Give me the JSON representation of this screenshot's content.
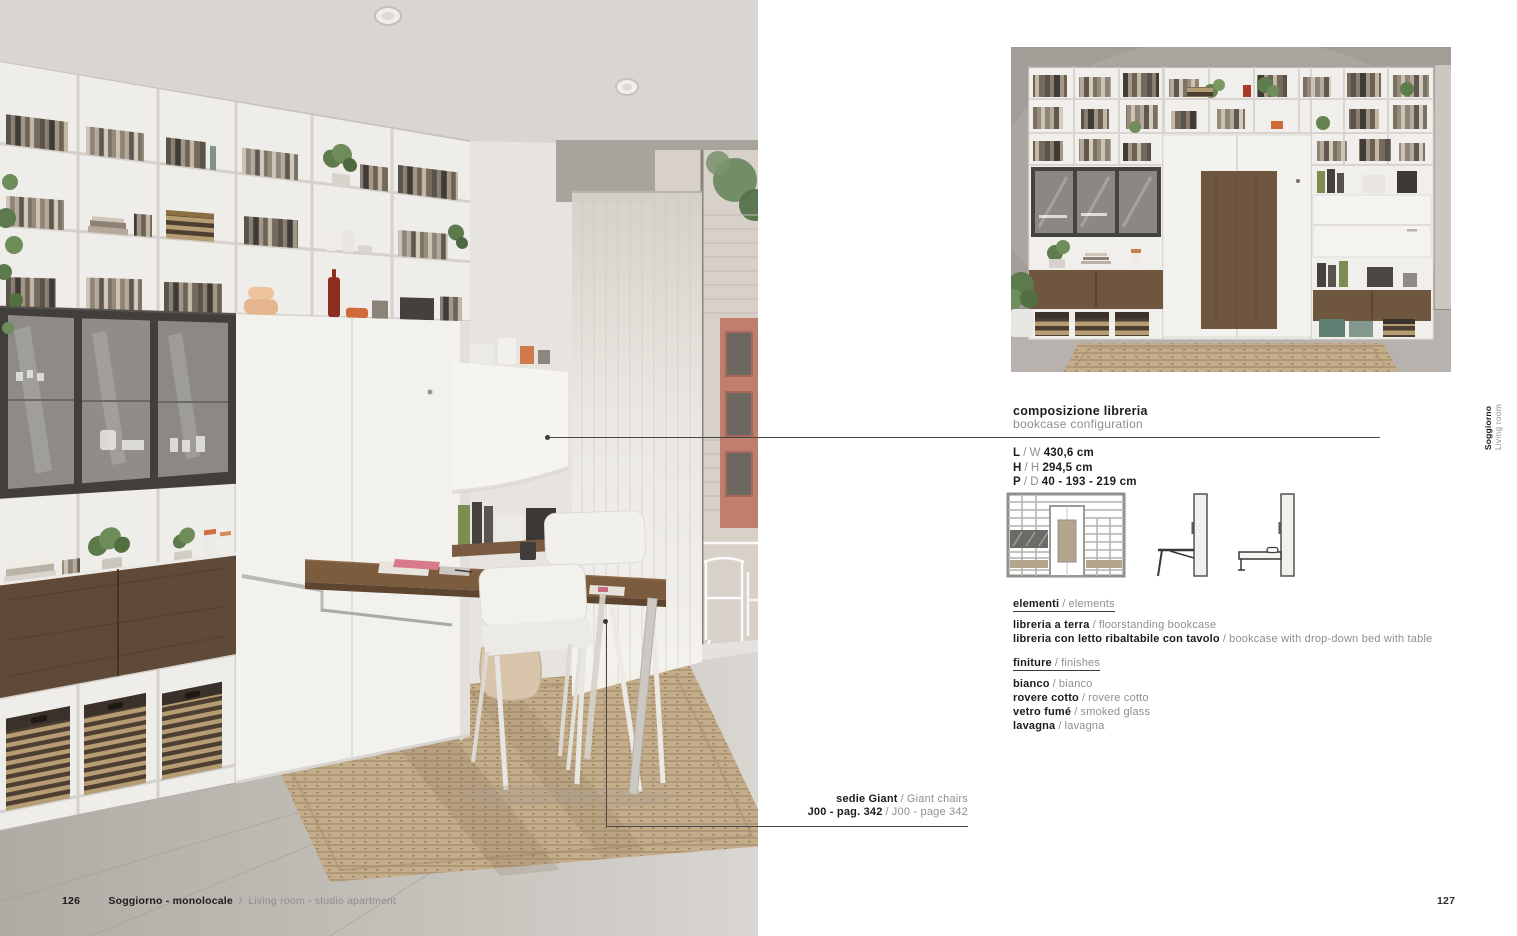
{
  "sep": "/",
  "footer": {
    "page_left": "126",
    "section_it": "Soggiorno - monolocale",
    "section_en": "Living room - studio apartment",
    "page_right": "127"
  },
  "side_tab": {
    "it": "Soggiorno",
    "en": "Living room"
  },
  "spec": {
    "title_it": "composizione libreria",
    "title_en": "bookcase configuration",
    "dimensions": [
      {
        "it": "L",
        "en": "W",
        "value": "430,6 cm"
      },
      {
        "it": "H",
        "en": "H",
        "value": "294,5 cm"
      },
      {
        "it": "P",
        "en": "D",
        "value": "40 - 193 - 219 cm"
      }
    ],
    "elements": {
      "h_it": "elementi",
      "h_en": "elements",
      "items": [
        {
          "it": "libreria a terra",
          "en": "floorstanding bookcase"
        },
        {
          "it": "libreria con letto ribaltabile con tavolo",
          "en": "bookcase with drop-down bed with table"
        }
      ]
    },
    "finishes": {
      "h_it": "finiture",
      "h_en": "finishes",
      "items": [
        {
          "it": "bianco",
          "en": "bianco"
        },
        {
          "it": "rovere cotto",
          "en": "rovere cotto"
        },
        {
          "it": "vetro fumé",
          "en": "smoked glass"
        },
        {
          "it": "lavagna",
          "en": "lavagna"
        }
      ]
    }
  },
  "callout_chairs": {
    "label_it": "sedie Giant",
    "label_en": "Giant chairs",
    "ref_it": "J00 - pag. 342",
    "ref_en": "J00 - page 342"
  },
  "colors": {
    "text": "#1d1c1a",
    "muted": "#8f8d8a",
    "walnut": "#6f563e",
    "jute_rug": "#c3ab88",
    "glass_frame": "#413e3b",
    "leader_line": "#4a4846"
  }
}
